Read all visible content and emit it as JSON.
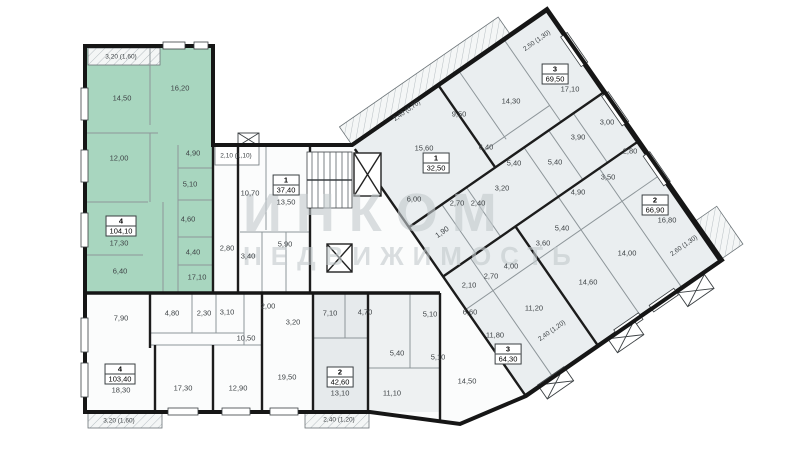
{
  "canvas": {
    "width": 800,
    "height": 450,
    "background": "#ffffff"
  },
  "colors": {
    "highlight": "#a8d6bf",
    "unit_gray": "#eaeef0",
    "unit_gray_dark": "#e6eaec",
    "wall": "#161616"
  },
  "watermark": {
    "line1": "ИНКОМ",
    "line2": "НЕДВИЖИМОСТЬ"
  },
  "highlighted_unit": {
    "number": "4",
    "area": "104,10"
  },
  "units": [
    {
      "number": "4",
      "area": "104,10",
      "x": 121,
      "y": 226,
      "highlighted": true
    },
    {
      "number": "1",
      "area": "37,40",
      "x": 286,
      "y": 185,
      "highlighted": false
    },
    {
      "number": "1",
      "area": "32,50",
      "x": 436,
      "y": 163,
      "highlighted": false
    },
    {
      "number": "3",
      "area": "69,50",
      "x": 555,
      "y": 74,
      "highlighted": false
    },
    {
      "number": "2",
      "area": "66,90",
      "x": 655,
      "y": 205,
      "highlighted": false
    },
    {
      "number": "3",
      "area": "64,30",
      "x": 508,
      "y": 354,
      "highlighted": false
    },
    {
      "number": "2",
      "area": "42,60",
      "x": 340,
      "y": 377,
      "highlighted": false
    },
    {
      "number": "4",
      "area": "103,40",
      "x": 120,
      "y": 374,
      "highlighted": false
    }
  ],
  "room_labels": [
    {
      "text": "3,20 (1,60)",
      "x": 121,
      "y": 57,
      "small": true
    },
    {
      "text": "14,50",
      "x": 122,
      "y": 98
    },
    {
      "text": "16,20",
      "x": 180,
      "y": 88
    },
    {
      "text": "12,00",
      "x": 119,
      "y": 158
    },
    {
      "text": "4,90",
      "x": 193,
      "y": 153
    },
    {
      "text": "5,10",
      "x": 190,
      "y": 184
    },
    {
      "text": "4,60",
      "x": 188,
      "y": 219
    },
    {
      "text": "17,30",
      "x": 119,
      "y": 243
    },
    {
      "text": "4,40",
      "x": 193,
      "y": 252
    },
    {
      "text": "6,40",
      "x": 120,
      "y": 271
    },
    {
      "text": "17,10",
      "x": 197,
      "y": 277
    },
    {
      "text": "2,10 (1,10)",
      "x": 236,
      "y": 156,
      "small": true
    },
    {
      "text": "10,70",
      "x": 250,
      "y": 193
    },
    {
      "text": "13,50",
      "x": 286,
      "y": 202
    },
    {
      "text": "5,90",
      "x": 285,
      "y": 244
    },
    {
      "text": "3,40",
      "x": 248,
      "y": 256
    },
    {
      "text": "2,80",
      "x": 227,
      "y": 248
    },
    {
      "text": "2,40 (0,70)",
      "x": 407,
      "y": 111,
      "rot": -35,
      "small": true
    },
    {
      "text": "15,60",
      "x": 424,
      "y": 148
    },
    {
      "text": "6,00",
      "x": 414,
      "y": 199
    },
    {
      "text": "9,50",
      "x": 459,
      "y": 114
    },
    {
      "text": "14,30",
      "x": 511,
      "y": 101
    },
    {
      "text": "2,50 (1,30)",
      "x": 537,
      "y": 41,
      "rot": -35,
      "small": true
    },
    {
      "text": "17,10",
      "x": 570,
      "y": 89
    },
    {
      "text": "6,40",
      "x": 486,
      "y": 147
    },
    {
      "text": "3,90",
      "x": 578,
      "y": 137
    },
    {
      "text": "5,40",
      "x": 514,
      "y": 163
    },
    {
      "text": "5,40",
      "x": 555,
      "y": 162
    },
    {
      "text": "3,00",
      "x": 607,
      "y": 122
    },
    {
      "text": "2,80",
      "x": 630,
      "y": 151
    },
    {
      "text": "3,50",
      "x": 608,
      "y": 177
    },
    {
      "text": "4,90",
      "x": 578,
      "y": 192
    },
    {
      "text": "16,80",
      "x": 667,
      "y": 220
    },
    {
      "text": "2,60 (1,30)",
      "x": 684,
      "y": 246,
      "rot": -35,
      "small": true
    },
    {
      "text": "14,00",
      "x": 627,
      "y": 253
    },
    {
      "text": "14,60",
      "x": 588,
      "y": 282
    },
    {
      "text": "3,20",
      "x": 502,
      "y": 188
    },
    {
      "text": "2,70",
      "x": 457,
      "y": 203
    },
    {
      "text": "2,40",
      "x": 478,
      "y": 203
    },
    {
      "text": "1,90",
      "x": 442,
      "y": 232,
      "rot": -35
    },
    {
      "text": "5,40",
      "x": 562,
      "y": 228
    },
    {
      "text": "3,60",
      "x": 543,
      "y": 243
    },
    {
      "text": "4,00",
      "x": 511,
      "y": 266
    },
    {
      "text": "2,70",
      "x": 491,
      "y": 276
    },
    {
      "text": "2,10",
      "x": 469,
      "y": 285
    },
    {
      "text": "6,60",
      "x": 470,
      "y": 312
    },
    {
      "text": "11,20",
      "x": 534,
      "y": 308
    },
    {
      "text": "11,80",
      "x": 495,
      "y": 335
    },
    {
      "text": "14,50",
      "x": 467,
      "y": 381
    },
    {
      "text": "2,40 (1,20)",
      "x": 552,
      "y": 331,
      "rot": -35,
      "small": true
    },
    {
      "text": "7,90",
      "x": 121,
      "y": 318
    },
    {
      "text": "4,80",
      "x": 172,
      "y": 313
    },
    {
      "text": "2,30",
      "x": 204,
      "y": 313
    },
    {
      "text": "3,10",
      "x": 227,
      "y": 312
    },
    {
      "text": "2,00",
      "x": 268,
      "y": 306
    },
    {
      "text": "3,20",
      "x": 293,
      "y": 322
    },
    {
      "text": "10,50",
      "x": 246,
      "y": 338
    },
    {
      "text": "18,30",
      "x": 121,
      "y": 390
    },
    {
      "text": "17,30",
      "x": 183,
      "y": 388
    },
    {
      "text": "12,90",
      "x": 238,
      "y": 388
    },
    {
      "text": "19,50",
      "x": 287,
      "y": 377
    },
    {
      "text": "3,20 (1,60)",
      "x": 119,
      "y": 421,
      "small": true
    },
    {
      "text": "7,10",
      "x": 330,
      "y": 313
    },
    {
      "text": "4,70",
      "x": 365,
      "y": 312
    },
    {
      "text": "5,10",
      "x": 430,
      "y": 314
    },
    {
      "text": "5,40",
      "x": 397,
      "y": 353
    },
    {
      "text": "5,10",
      "x": 438,
      "y": 357
    },
    {
      "text": "13,10",
      "x": 340,
      "y": 393
    },
    {
      "text": "11,10",
      "x": 392,
      "y": 393
    },
    {
      "text": "2,40 (1,20)",
      "x": 339,
      "y": 420,
      "small": true
    }
  ]
}
